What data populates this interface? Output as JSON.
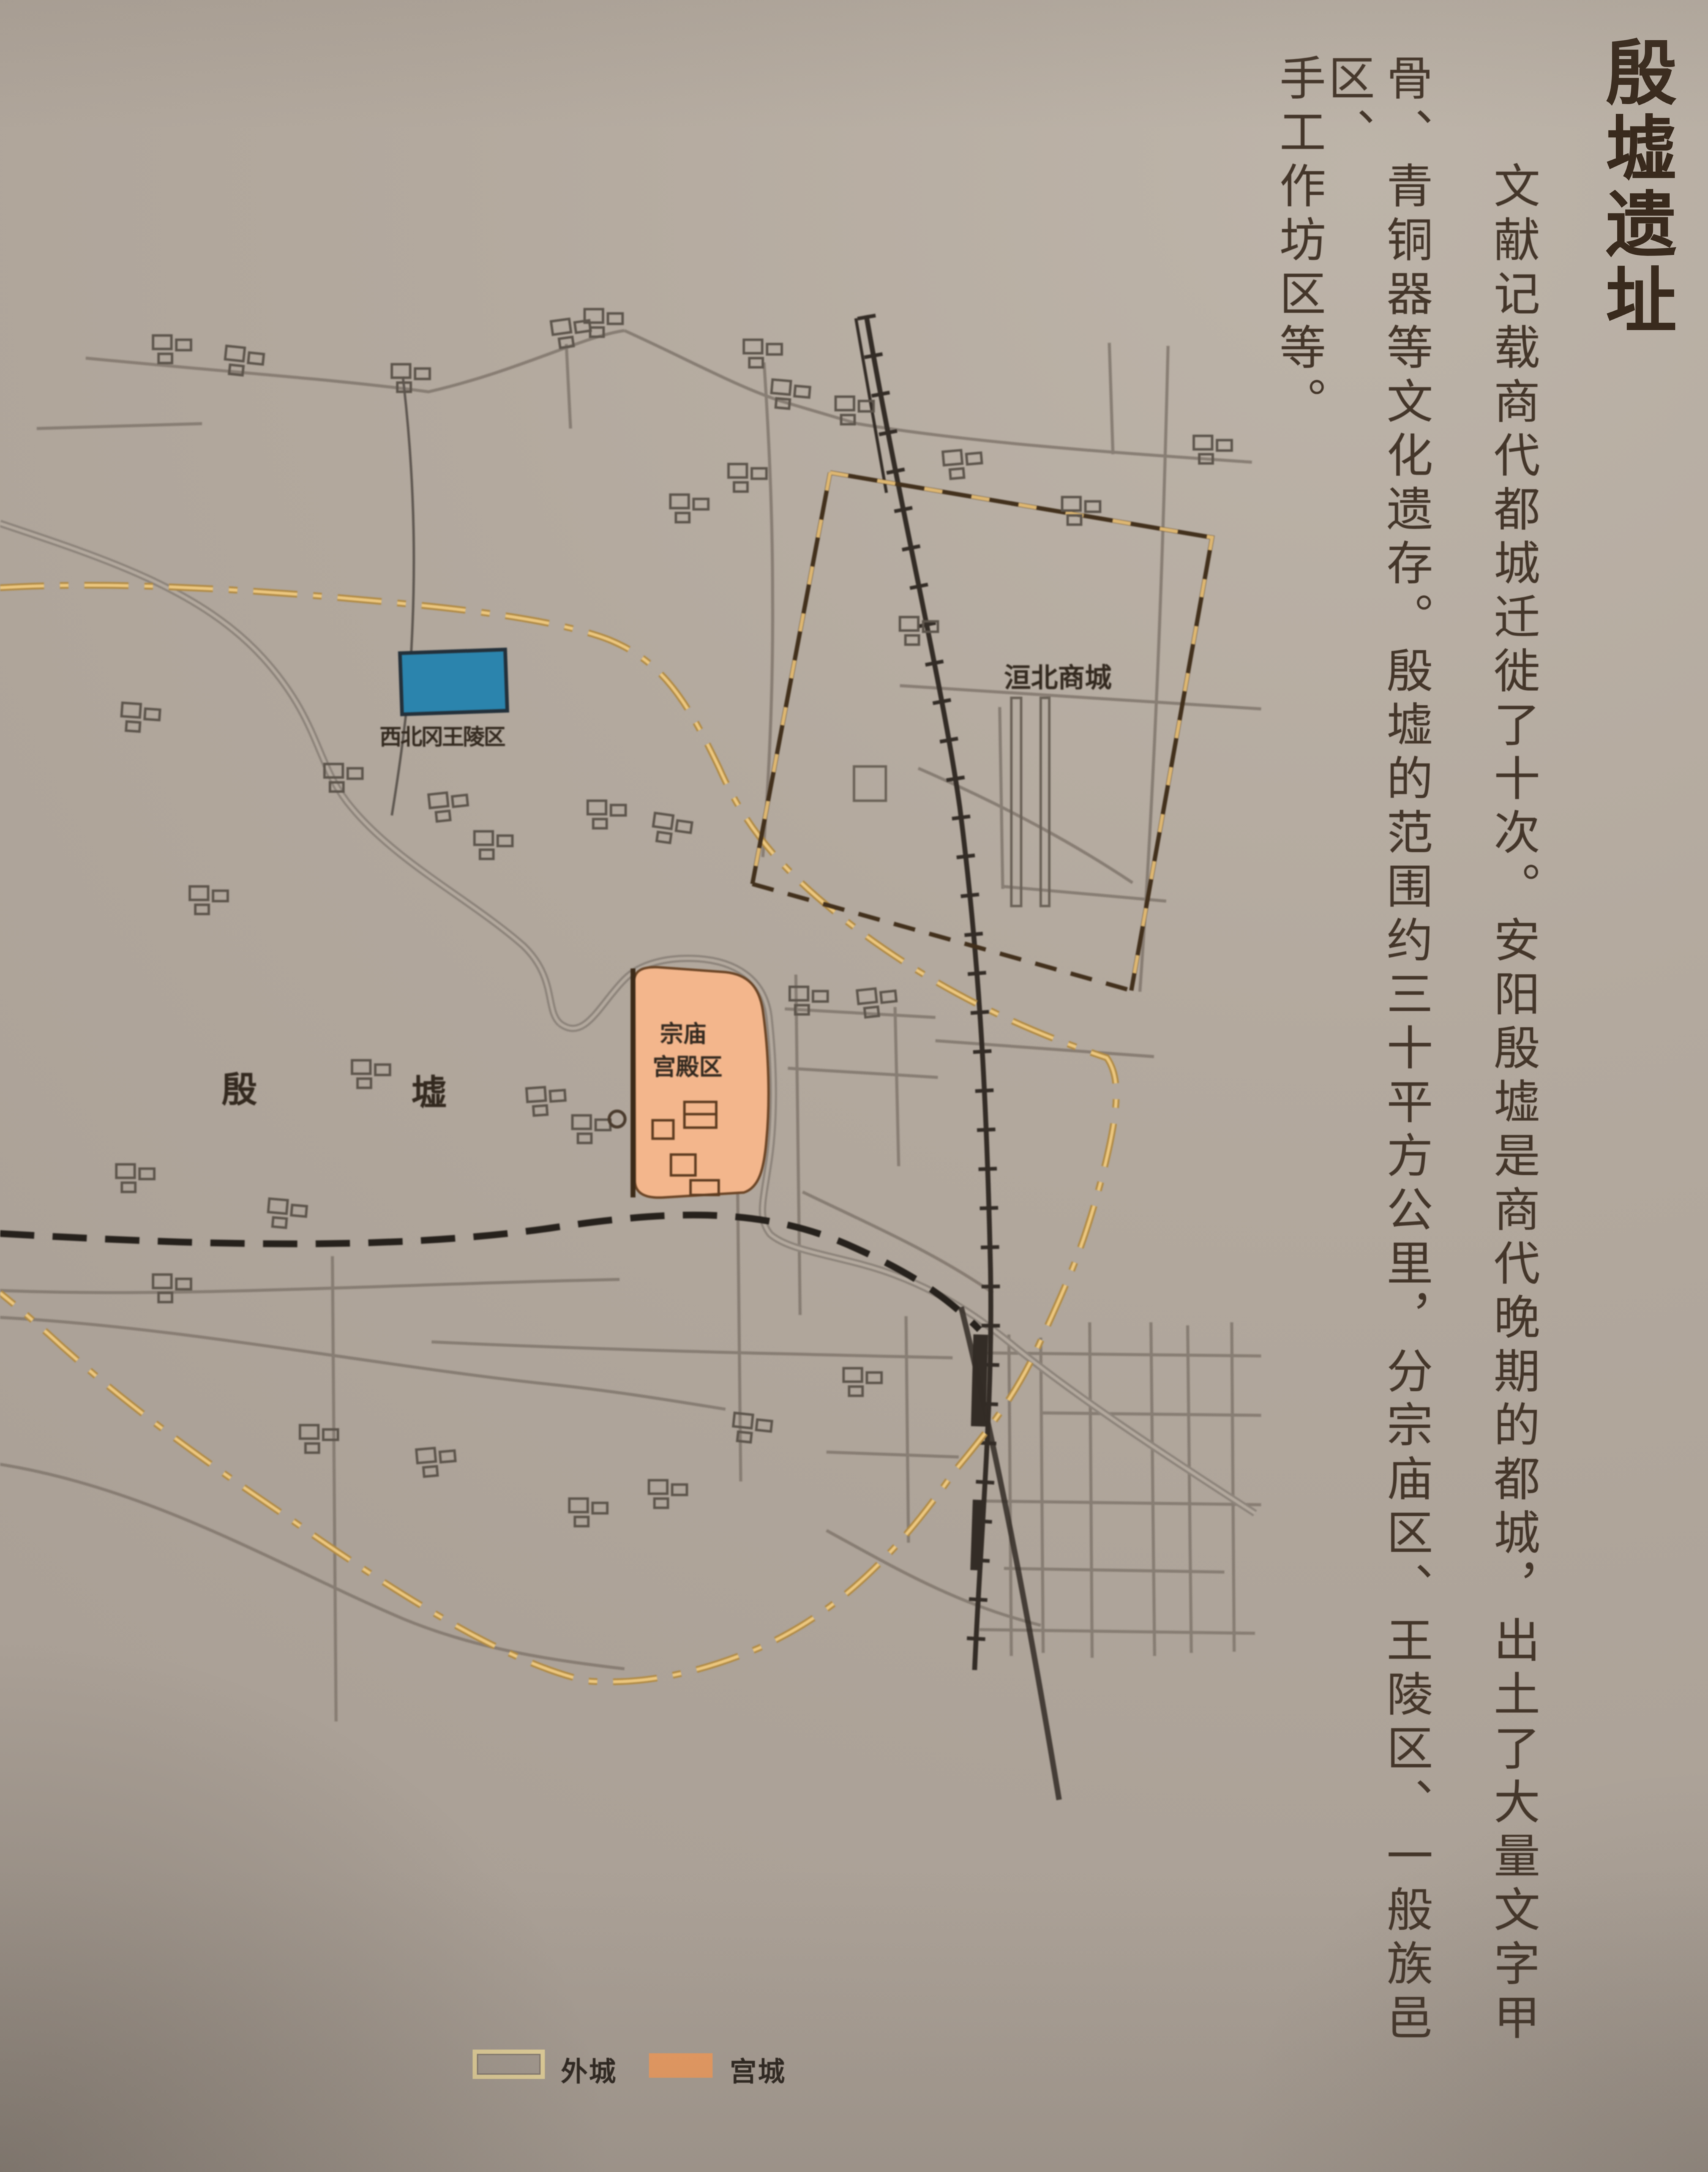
{
  "panel": {
    "title": "殷墟遗址",
    "body": {
      "columns": [
        "文献记载商代都城迁徙了十次。安阳殷墟是商代晚期的都城，出土了大量文字甲",
        "骨、青铜器等文化遗存。殷墟的范围约三十平方公里，分宗庙区、王陵区、一般族邑区、",
        "手工作坊区等。"
      ]
    }
  },
  "map": {
    "labels": {
      "royal_cemetery": "西北冈王陵区",
      "huanbei_city": "洹北商城",
      "palace_line1": "宗庙",
      "palace_line2": "宫殿区",
      "yin": "殷",
      "xu": "墟"
    },
    "legend": {
      "outer_city": {
        "label": "外城",
        "swatch_border": "#ecd9a0"
      },
      "palace_city": {
        "label": "宫城",
        "swatch_fill": "#ee9e63"
      }
    }
  },
  "colors": {
    "background": "#b3a99e",
    "body_ink": "#44362a",
    "title_ink": "#392a1d",
    "road_gray": "#847a70",
    "railway_black": "#332c26",
    "outer_boundary_gold": "#e3bc74",
    "city_wall_brown": "#42301c",
    "royal_cemetery_blue": "#2b84ad",
    "palace_orange": "#f3b68c"
  }
}
